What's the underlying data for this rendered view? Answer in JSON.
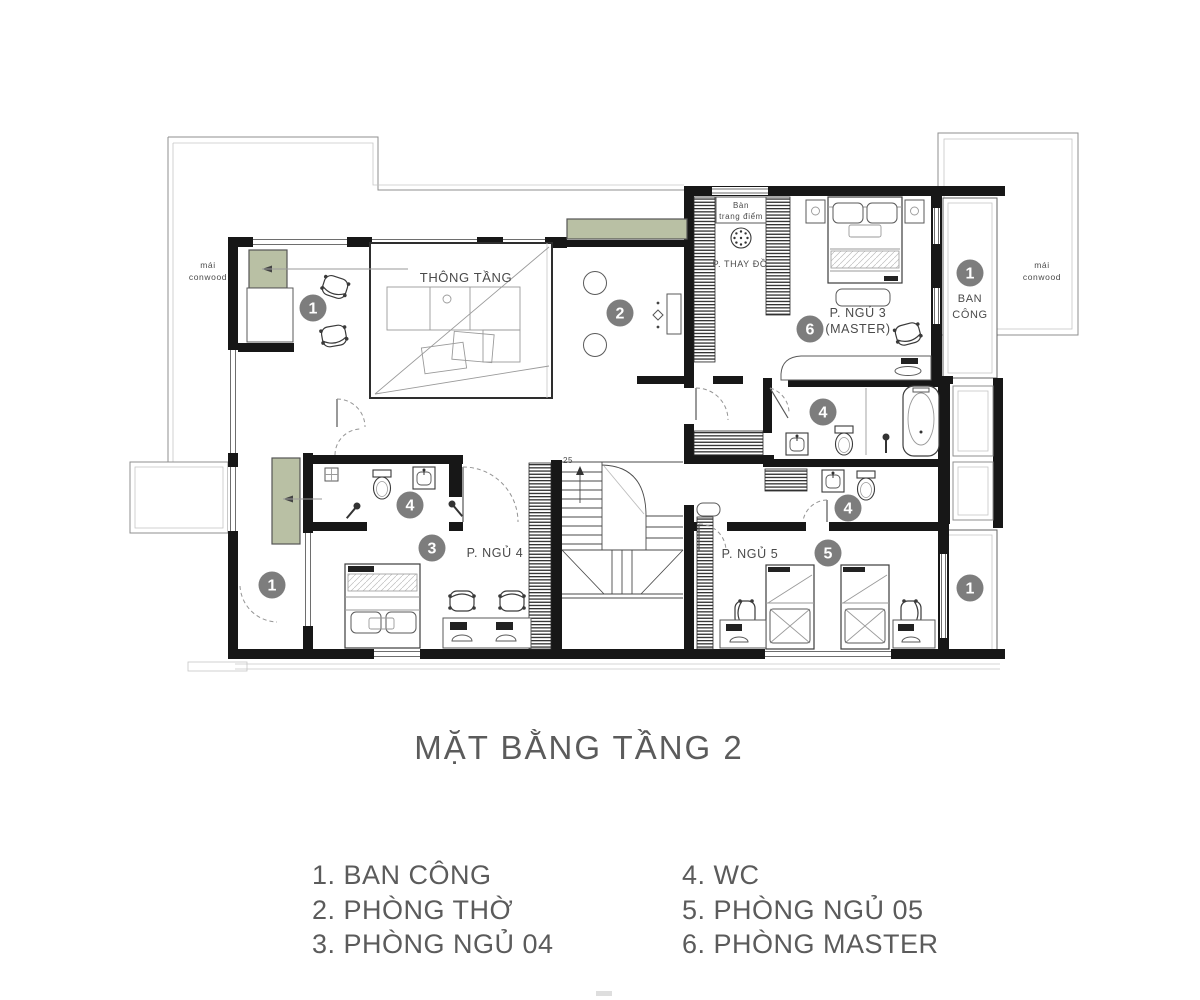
{
  "title": "MẶT BẰNG TẦNG 2",
  "legend": {
    "column1": [
      "1. BAN CÔNG",
      "2. PHÒNG THỜ",
      "3. PHÒNG NGỦ 04"
    ],
    "column2": [
      "4. WC",
      "5. PHÒNG NGỦ 05",
      "6. PHÒNG MASTER"
    ]
  },
  "rooms": {
    "void": "THÔNG TẦNG",
    "dressing_table_line1": "Bàn",
    "dressing_table_line2": "trang điểm",
    "dressing_room": "P. THAY ĐỒ",
    "master_line1": "P. NGỦ 3",
    "master_line2": "(MASTER)",
    "balcony_line1": "BAN",
    "balcony_line2": "CÔNG",
    "bedroom4": "P. NGỦ 4",
    "bedroom5": "P. NGỦ 5",
    "roof_line1": "mái",
    "roof_line2": "conwood",
    "stair_steps": "25"
  },
  "badges": {
    "balcony_top_left": "1",
    "worship": "2",
    "bedroom4": "3",
    "wc_bed4": "4",
    "wc_master": "4",
    "wc_bed5": "4",
    "bedroom5": "5",
    "master": "6",
    "balcony_top_right": "1",
    "balcony_bottom_left": "1",
    "balcony_bottom_right": "1"
  },
  "colors": {
    "wall": "#171717",
    "planter_green": "#b9c0a4",
    "badge_gray": "#7d7d7d",
    "label_gray": "#4a4a4a"
  }
}
